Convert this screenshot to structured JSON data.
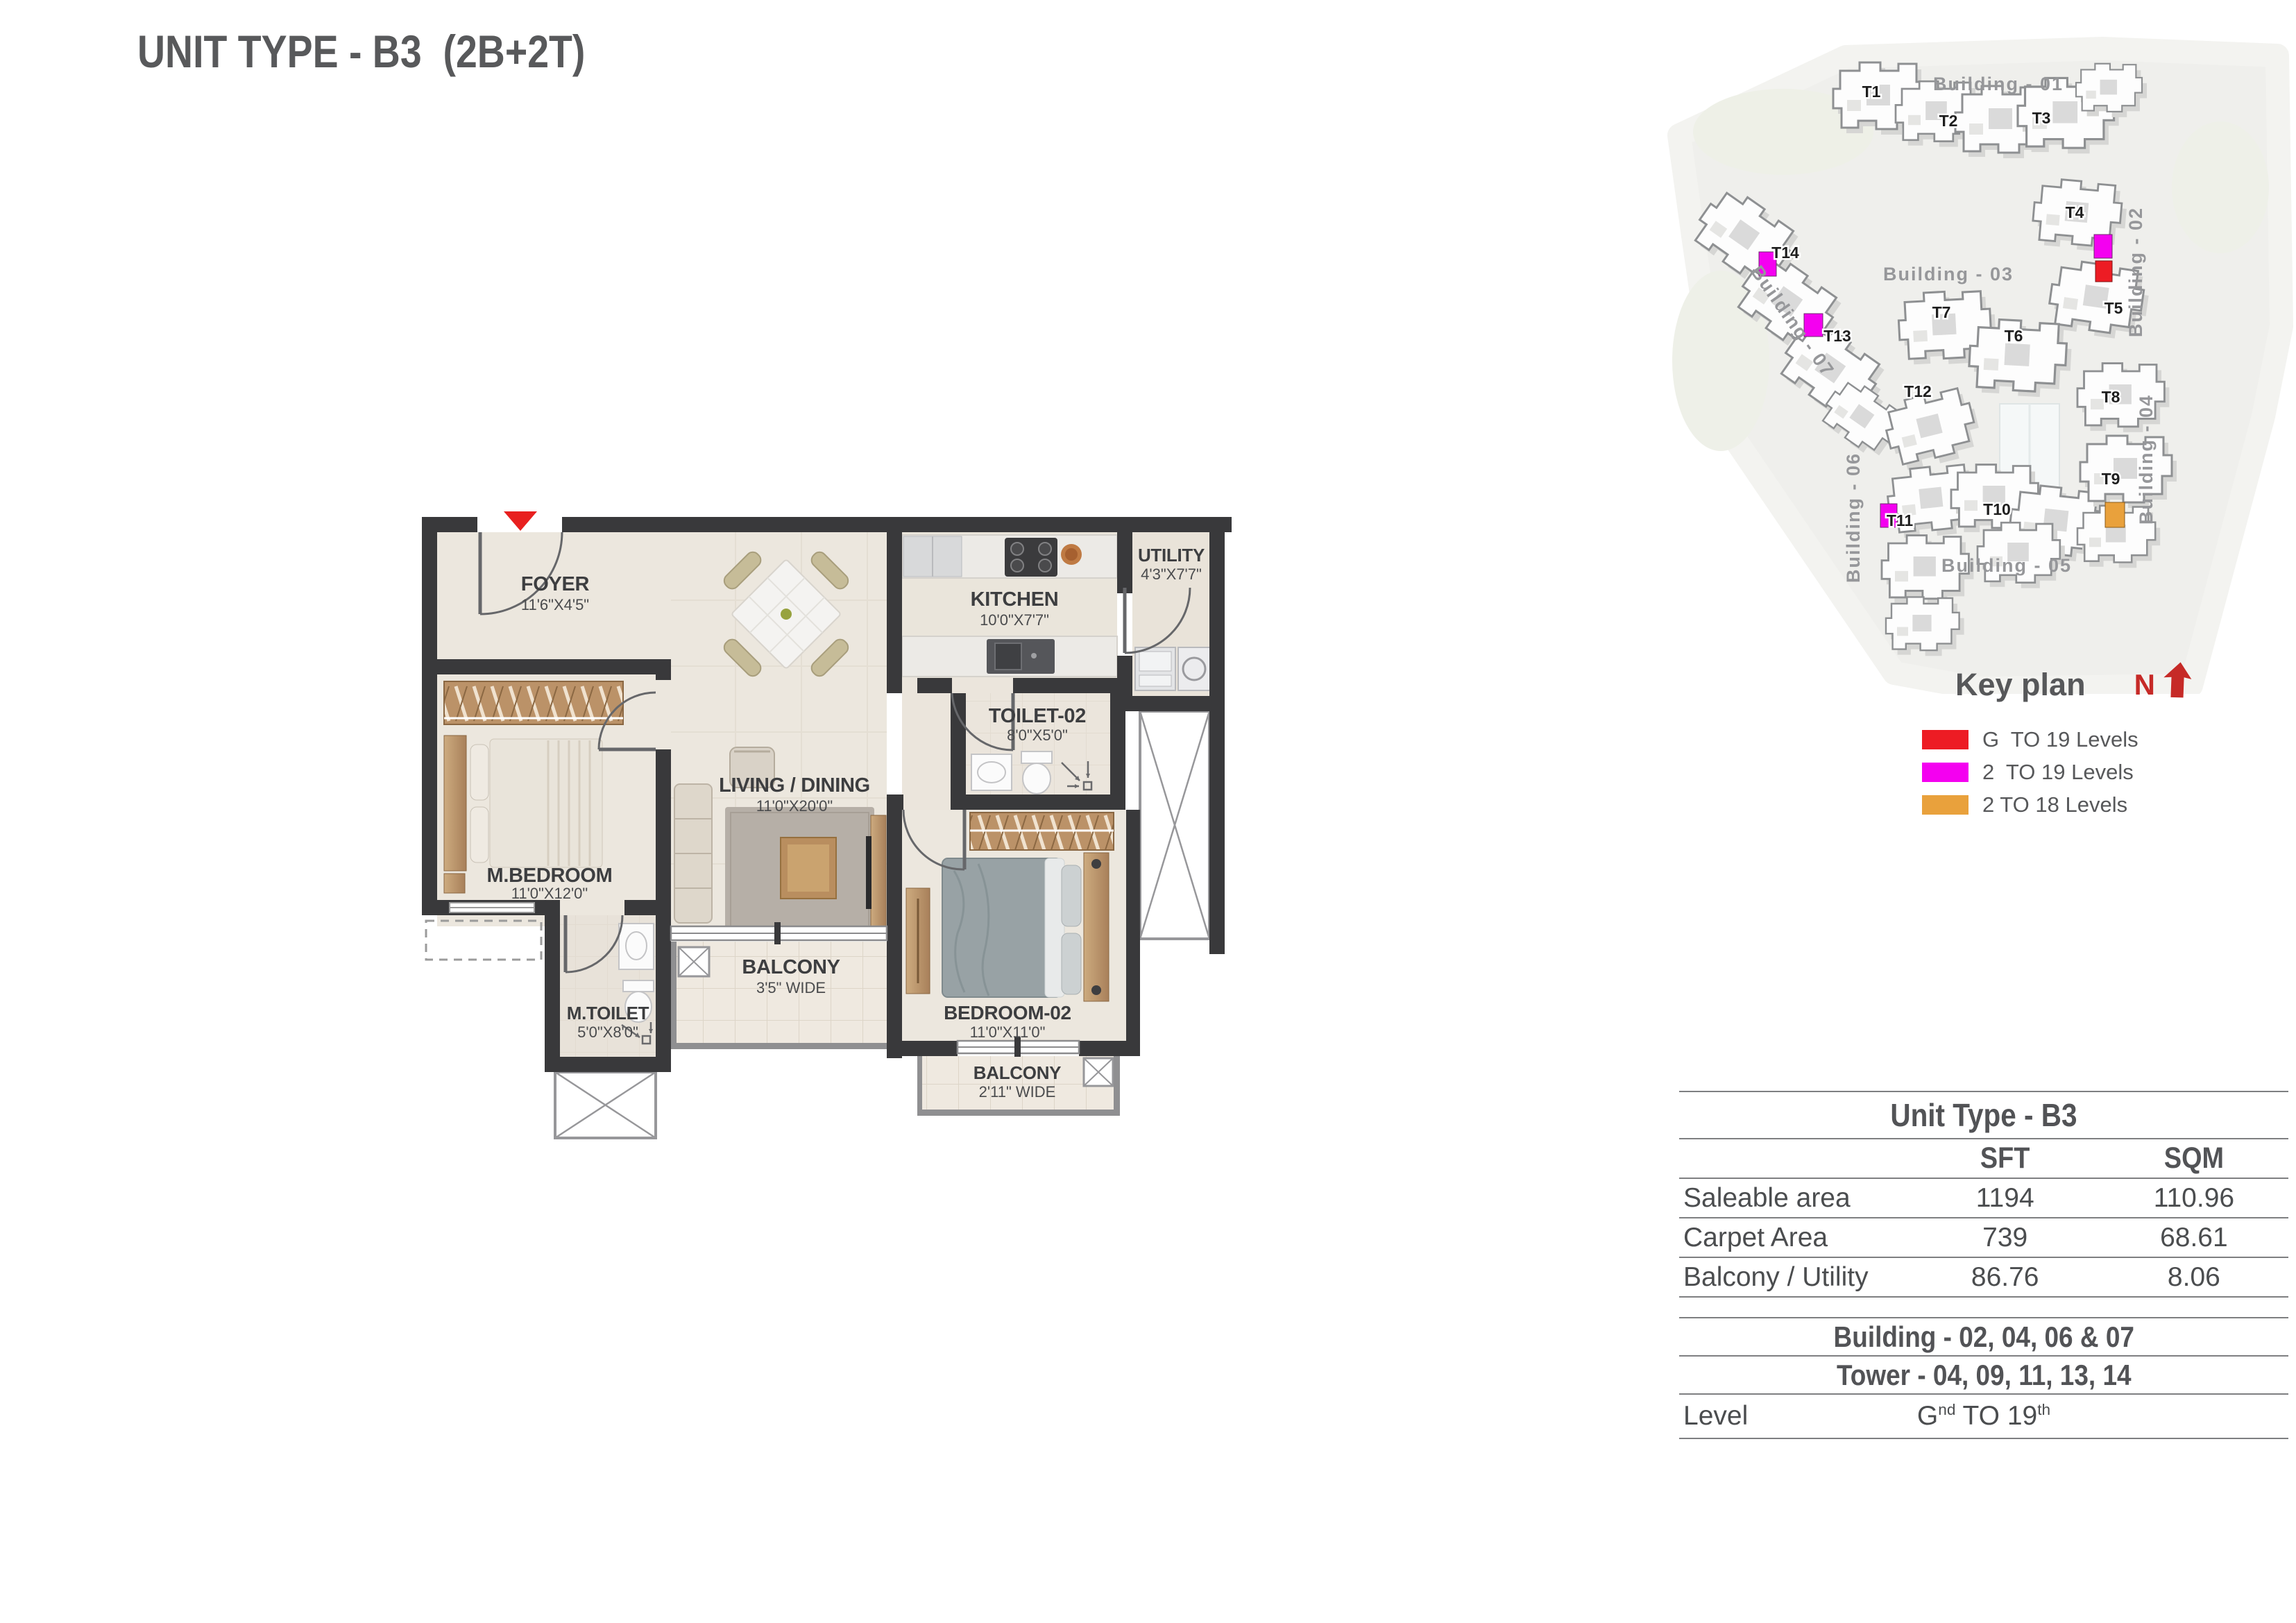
{
  "page": {
    "title": "UNIT TYPE - B3  (2B+2T)"
  },
  "floor_plan": {
    "entry_marker": "entry-arrow",
    "rooms": [
      {
        "name": "FOYER",
        "dim": "11'6\"X4'5\""
      },
      {
        "name": "LIVING / DINING",
        "dim": "11'0\"X20'0\""
      },
      {
        "name": "M.BEDROOM",
        "dim": "11'0\"X12'0\""
      },
      {
        "name": "KITCHEN",
        "dim": "10'0\"X7'7\""
      },
      {
        "name": "UTILITY",
        "dim": "4'3\"X7'7\""
      },
      {
        "name": "TOILET-02",
        "dim": "8'0\"X5'0\""
      },
      {
        "name": "M.TOILET",
        "dim": "5'0\"X8'0\""
      },
      {
        "name": "BALCONY",
        "dim": "3'5\" WIDE"
      },
      {
        "name": "BEDROOM-02",
        "dim": "11'0\"X11'0\""
      },
      {
        "name": "BALCONY",
        "dim": "2'11\" WIDE"
      }
    ]
  },
  "key_plan": {
    "title": "Key plan",
    "north": "N",
    "buildings": [
      "Building - 01",
      "Building - 02",
      "Building - 03",
      "Building - 04",
      "Building - 05",
      "Building - 06",
      "Building - 07"
    ],
    "towers": [
      "T1",
      "T2",
      "T3",
      "T4",
      "T5",
      "T6",
      "T7",
      "T8",
      "T9",
      "T10",
      "T11",
      "T12",
      "T13",
      "T14"
    ],
    "highlight_colors": {
      "red": "#ed1c24",
      "magenta": "#f400f0",
      "orange": "#e9a13c"
    },
    "legend": [
      {
        "color": "#ed1c24",
        "label": "G  TO 19 Levels"
      },
      {
        "color": "#f400f0",
        "label": "2  TO 19 Levels"
      },
      {
        "color": "#e9a13c",
        "label": "2 TO 18 Levels"
      }
    ]
  },
  "table": {
    "title": "Unit Type - B3",
    "col_sft": "SFT",
    "col_sqm": "SQM",
    "rows": [
      {
        "label": "Saleable area",
        "sft": "1194",
        "sqm": "110.96"
      },
      {
        "label": "Carpet Area",
        "sft": "739",
        "sqm": "68.61"
      },
      {
        "label": "Balcony / Utility",
        "sft": "86.76",
        "sqm": "8.06"
      }
    ],
    "building_line": "Building - 02, 04, 06 & 07",
    "tower_line": "Tower - 04, 09, 11, 13, 14",
    "level_label": "Level",
    "level_main": "G",
    "level_sup1": "nd",
    "level_mid": " TO 19",
    "level_sup2": "th"
  }
}
